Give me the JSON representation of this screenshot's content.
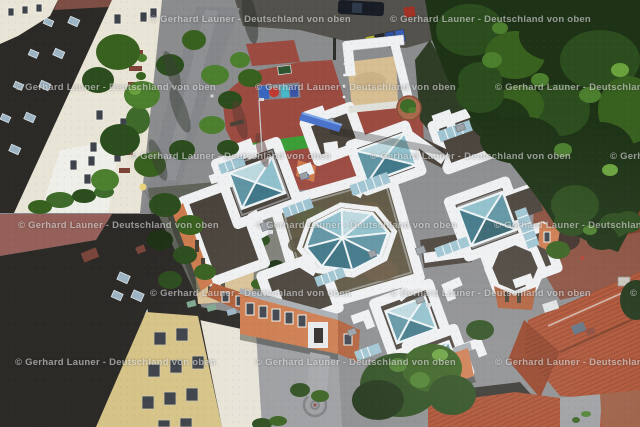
{
  "watermark": {
    "text": "© Gerhard Launer - Deutschland von oben",
    "color": "#ffffff",
    "opacity": 0.52,
    "instances": [
      {
        "x": 150,
        "y": 21
      },
      {
        "x": 390,
        "y": 21
      },
      {
        "x": 15,
        "y": 89
      },
      {
        "x": 255,
        "y": 89
      },
      {
        "x": 495,
        "y": 89
      },
      {
        "x": 130,
        "y": 158
      },
      {
        "x": 370,
        "y": 158
      },
      {
        "x": 610,
        "y": 158
      },
      {
        "x": 18,
        "y": 227
      },
      {
        "x": 256,
        "y": 227
      },
      {
        "x": 494,
        "y": 227
      },
      {
        "x": 150,
        "y": 295
      },
      {
        "x": 390,
        "y": 295
      },
      {
        "x": 630,
        "y": 295
      },
      {
        "x": 15,
        "y": 364
      },
      {
        "x": 255,
        "y": 364
      },
      {
        "x": 495,
        "y": 364
      }
    ]
  },
  "palette": {
    "base": "#8b8c8e",
    "pavement": "#8b8c8e",
    "pavLight": "#9b9da0",
    "asphalt": "#53524c",
    "path": "#85878b",
    "creamWall": "#e9e5d6",
    "creamLight": "#efefe9",
    "windowDark": "#3e434b",
    "frameWhite": "#f2f1ea",
    "darkRoof": "#2c2a27",
    "ridgeRed": "#7d4f44",
    "roofWin": "#9db4c4",
    "roofWinFrame": "#dce5ea",
    "pinkRoof": "#96605a",
    "chimney": "#7a453a",
    "yellowWall": "#d6c387",
    "gableWall": "#e7e3d7",
    "tanWall": "#d8c298",
    "whiteBand": "#eef0f2",
    "bandShade": "#b7bcc2",
    "metalRoof": "#a7adb2",
    "gravel": "#4a433b",
    "sedum": "#5f5742",
    "sedumGreen": "#5c6040",
    "sedumBrown": "#6b5b44",
    "glass1": "#bcd9df",
    "glass2": "#8fc0cc",
    "glass3": "#5f94a3",
    "glass4": "#3f7788",
    "glassFrame": "#eef3f5",
    "cleresGlass": "#9fc4d2",
    "orangeWall": "#cd7b4e",
    "orangeDark": "#b05f3a",
    "redPaving": "#9c4b41",
    "redCourt": "#8a4f3e",
    "redCourtLight": "#a25a42",
    "sand": "#d6be92",
    "turf": "#3c9e36",
    "treeDark": "#1e3316",
    "treeMid": "#2c4d1e",
    "treeMid2": "#38601f",
    "treeLight": "#4c7f2e",
    "treeHi": "#6aa23e",
    "shrub": "#3e6a2b",
    "redRoof": "#ad4f30",
    "redRoofDark": "#7e3a22",
    "redRoofBrown": "#9a5b41",
    "graffBlue": "#3a66c0",
    "graffRed": "#c23b31",
    "graffTeal": "#49b8c8",
    "equipBlue": "#4a74cc",
    "binYellow": "#b7b62e",
    "binDark": "#23262b",
    "binBlue": "#2f4f9e",
    "binBlue2": "#3a5fb4",
    "carDark": "#181c24",
    "carGlass": "#2e3a4a",
    "redCar": "#a33226",
    "van": "#dfe2e4",
    "planterPot": "#a96a4e",
    "planterGreen": "#3f6b28",
    "lampGlow": "#e8d27a",
    "watermark": "rgba(255,255,255,0.52)"
  }
}
